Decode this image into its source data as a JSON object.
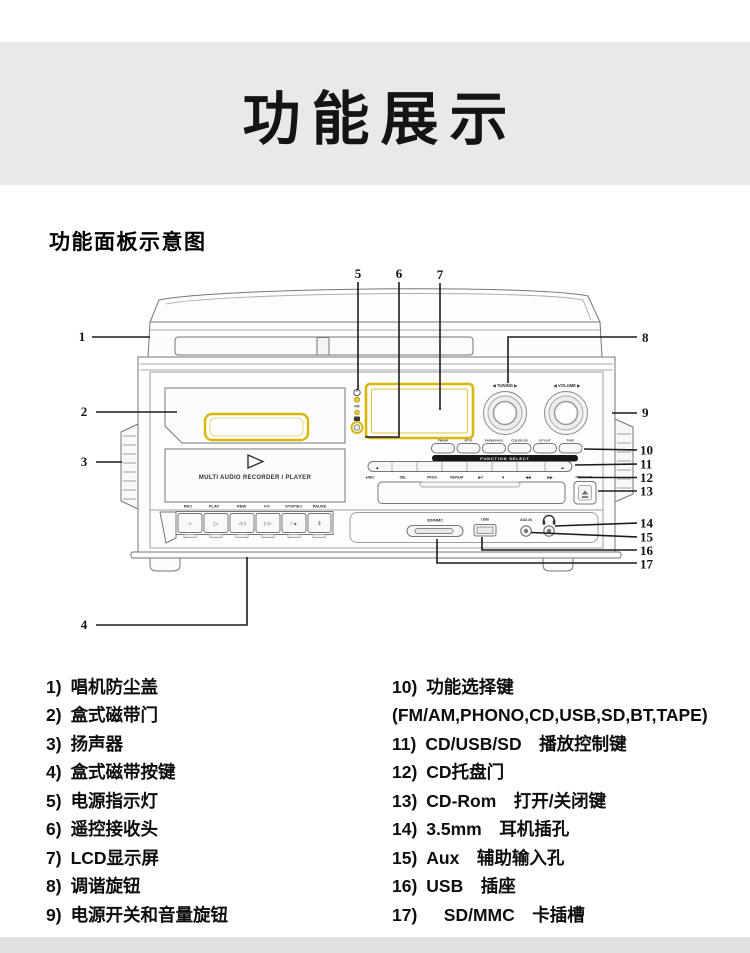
{
  "page": {
    "banner_title": "功能展示",
    "section_heading": "功能面板示意图"
  },
  "device": {
    "brand_text": "MULTI AUDIO RECORDER / PLAYER",
    "knob_tuning_label": "◀  TUNING  ▶",
    "knob_volume_label": "◀ VOLUME ▶",
    "indicator_fm_label": "FM",
    "function_bar_label": "FUNCTION SELECT",
    "function_options": [
      "FM/AM",
      "BT IR",
      "PHONO/AUX",
      "CD/USB SD",
      "BT OUT",
      "TAPE"
    ],
    "cd_controls": [
      "●REC",
      "DEL",
      "PROG",
      "REPEAT",
      "▶‖",
      "■",
      "◀◀",
      "▶▶"
    ],
    "cd_row_left_cap": "◀",
    "cd_row_right_cap": "▶",
    "eject_label": "OPEN/CLOSE",
    "cassette_key_labels": [
      "REC",
      "PLAY",
      "REW",
      "F.F",
      "STOP/EJ",
      "PAUSE"
    ],
    "cassette_key_glyphs": [
      "○",
      "▷",
      "◁◁",
      "▷▷",
      "□▲",
      "‖"
    ],
    "ports": {
      "sd": "SD/MMC",
      "usb": "USB",
      "aux": "AUX-IN"
    }
  },
  "callouts": {
    "n1": "1",
    "n2": "2",
    "n3": "3",
    "n4": "4",
    "n5": "5",
    "n6": "6",
    "n7": "7",
    "n8": "8",
    "n9": "9",
    "n10": "10",
    "n11": "11",
    "n12": "12",
    "n13": "13",
    "n14": "14",
    "n15": "15",
    "n16": "16",
    "n17": "17"
  },
  "legend": {
    "left": [
      {
        "num": "1)",
        "text": "唱机防尘盖"
      },
      {
        "num": "2)",
        "text": "盒式磁带门"
      },
      {
        "num": "3)",
        "text": "扬声器"
      },
      {
        "num": "4)",
        "text": "盒式磁带按键"
      },
      {
        "num": "5)",
        "text": "电源指示灯"
      },
      {
        "num": "6)",
        "text": "遥控接收头"
      },
      {
        "num": "7)",
        "text": "LCD显示屏"
      },
      {
        "num": "8)",
        "text": "调谐旋钮"
      },
      {
        "num": "9)",
        "text": "电源开关和音量旋钮"
      }
    ],
    "right": [
      {
        "num": "10)",
        "text": "功能选择键"
      },
      {
        "num": "",
        "text": "(FM/AM,PHONO,CD,USB,SD,BT,TAPE)"
      },
      {
        "num": "11)",
        "text": "CD/USB/SD　播放控制键"
      },
      {
        "num": "12)",
        "text": "CD托盘门"
      },
      {
        "num": "13)",
        "text": "CD-Rom　打开/关闭键"
      },
      {
        "num": "14)",
        "text": "3.5mm　耳机插孔"
      },
      {
        "num": "15)",
        "text": "Aux　辅助输入孔"
      },
      {
        "num": "16)",
        "text": "USB　插座"
      },
      {
        "num": "17)",
        "text": "　SD/MMC　卡插槽"
      }
    ]
  }
}
